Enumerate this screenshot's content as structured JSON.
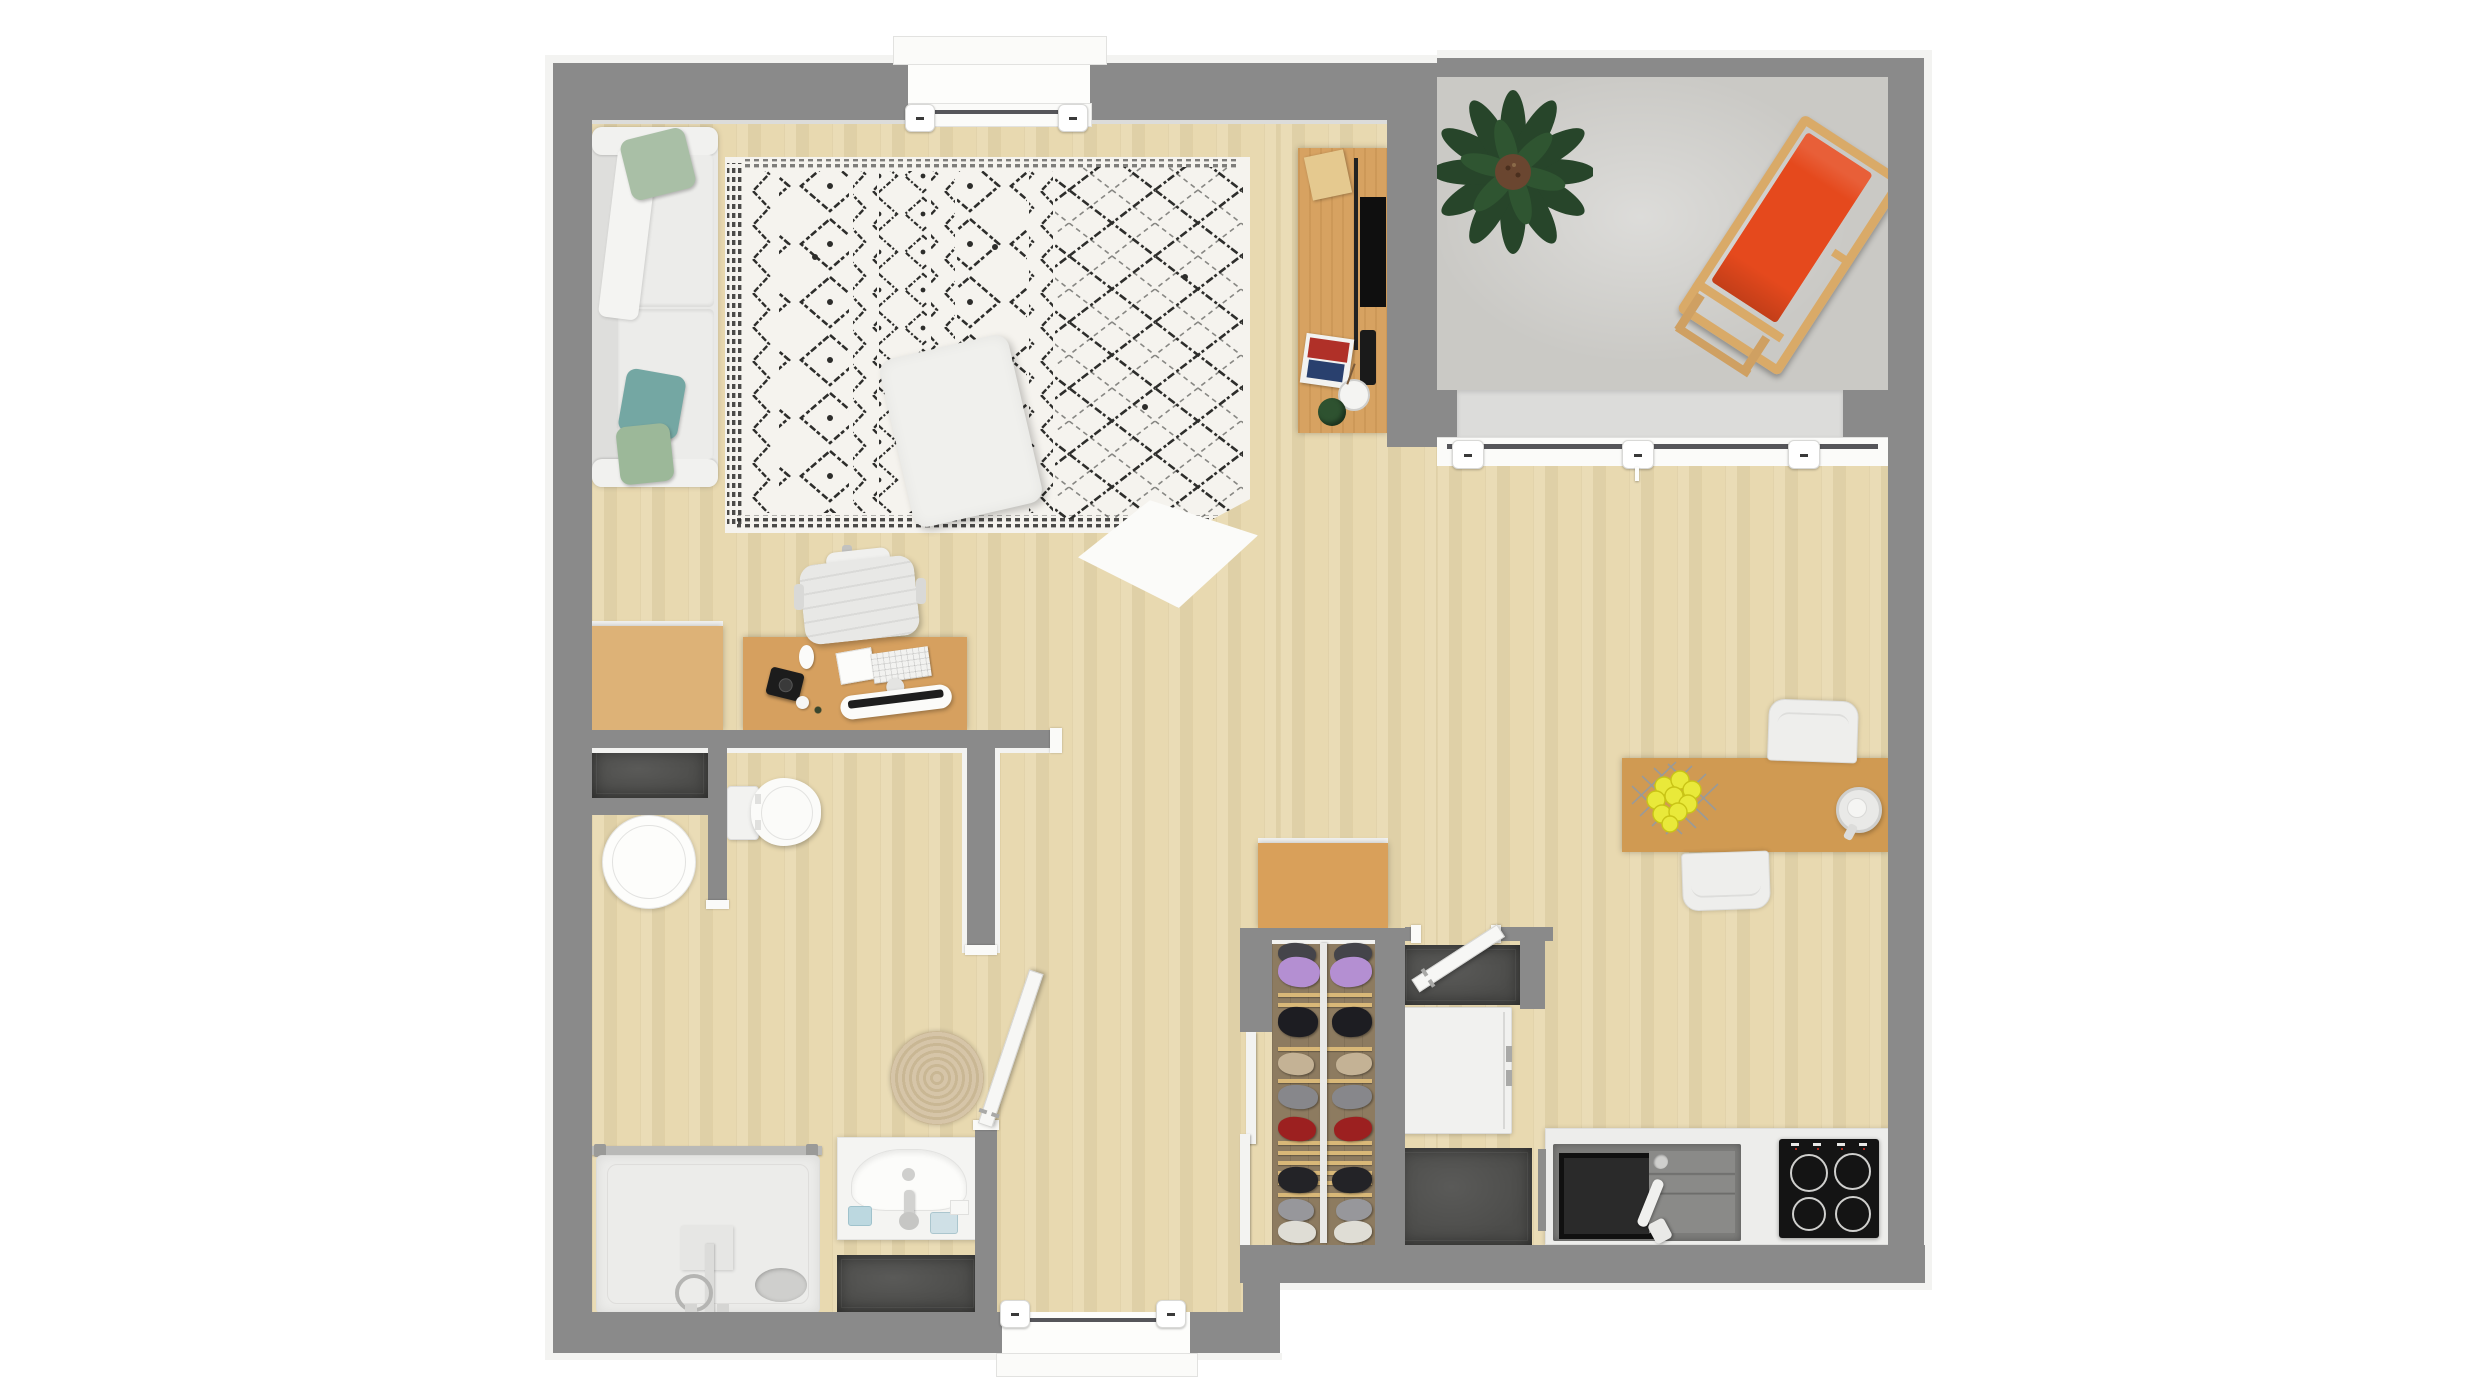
{
  "scene": {
    "title": "studio-apartment-floor-plan-top-view",
    "background": "#ffffff",
    "view": "top-down 3D render",
    "visible_text": "none"
  },
  "palette": {
    "wall": "#8a8a8a",
    "trim": "#f3f3f1",
    "wood": "#e8d8ae",
    "furnwood": "#d7a261",
    "furnwood2": "#ddb277",
    "framewood": "#d9aa68",
    "concrete": "#cac9c5",
    "tile": "#4c4c4a",
    "closetfloor": "#8d7b60",
    "accent": "#e5491d",
    "green": "#27452a",
    "slat": "#d9b878",
    "jute": "#d6c5a8",
    "rugbg": "#f5f3ee",
    "rugink": "#2d2d2b",
    "pillow_sage": "#a9bfa6",
    "pillow_teal": "#74a7a3",
    "lemon": "#e9e93a"
  },
  "rooms": [
    {
      "id": "living-room",
      "label": "Living room"
    },
    {
      "id": "balcony",
      "label": "Balcony"
    },
    {
      "id": "bathroom",
      "label": "Bathroom"
    },
    {
      "id": "hallway",
      "label": "Hallway"
    },
    {
      "id": "closet",
      "label": "Closet"
    },
    {
      "id": "entry",
      "label": "Entry"
    },
    {
      "id": "kitchen",
      "label": "Kitchen"
    },
    {
      "id": "dining-area",
      "label": "Dining area"
    }
  ],
  "doors": [
    {
      "id": "bathroom-door",
      "state": "open"
    },
    {
      "id": "entry-door",
      "state": "open"
    }
  ],
  "windows": [
    {
      "id": "living-room-window"
    },
    {
      "id": "balcony-window",
      "handles": 3
    },
    {
      "id": "hall-window",
      "handles": 2
    }
  ],
  "furniture": [
    {
      "id": "sofa",
      "label": "White sofa with pillows",
      "room": "living-room"
    },
    {
      "id": "berber-rug",
      "label": "Black and white Berber rug with folded corner",
      "room": "living-room"
    },
    {
      "id": "ottoman",
      "label": "White ottoman",
      "room": "living-room"
    },
    {
      "id": "tv-console",
      "label": "TV console with TV, magazines, vase and plant",
      "room": "living-room"
    },
    {
      "id": "desk",
      "label": "Desk with monitor, keyboard, mouse and camera",
      "room": "living-room"
    },
    {
      "id": "desk-chair",
      "label": "White office chair",
      "room": "living-room"
    },
    {
      "id": "low-cabinet",
      "label": "Low wooden cabinet",
      "room": "living-room"
    },
    {
      "id": "potted-plant",
      "label": "Large potted plant",
      "room": "balcony"
    },
    {
      "id": "deck-chair",
      "label": "Orange wooden deck chair",
      "room": "balcony"
    },
    {
      "id": "toilet",
      "label": "Toilet",
      "room": "bathroom"
    },
    {
      "id": "laundry-basket",
      "label": "Round laundry basket",
      "room": "bathroom"
    },
    {
      "id": "shower",
      "label": "Walk-in shower",
      "room": "bathroom"
    },
    {
      "id": "vanity-sink",
      "label": "Vanity sink",
      "room": "bathroom"
    },
    {
      "id": "jute-rug",
      "label": "Round jute rug",
      "room": "bathroom"
    },
    {
      "id": "dark-mat-bath",
      "label": "Dark tile mat",
      "room": "bathroom"
    },
    {
      "id": "dresser",
      "label": "Wooden dresser",
      "room": "closet"
    },
    {
      "id": "shoe-rack",
      "label": "Shoe rack with shoes",
      "room": "closet"
    },
    {
      "id": "washing-machine",
      "label": "White appliance",
      "room": "entry"
    },
    {
      "id": "entry-mats",
      "label": "Dark tile mats",
      "room": "entry"
    },
    {
      "id": "kitchen-counter",
      "label": "Kitchen counter",
      "room": "kitchen"
    },
    {
      "id": "kitchen-sink",
      "label": "Grey sink unit with faucet",
      "room": "kitchen"
    },
    {
      "id": "cooktop",
      "label": "Four-burner cooktop",
      "room": "kitchen"
    },
    {
      "id": "dining-table",
      "label": "Wooden dining table",
      "room": "dining-area"
    },
    {
      "id": "dining-chairs",
      "label": "Two white chairs",
      "room": "dining-area"
    },
    {
      "id": "fruit-basket",
      "label": "Wire basket with lemons",
      "room": "dining-area"
    },
    {
      "id": "glass-cup",
      "label": "Glass cup",
      "room": "dining-area"
    }
  ],
  "closet": {
    "slats": [
      52,
      62,
      106,
      138,
      200,
      210,
      220,
      230,
      240,
      252
    ],
    "shoe_rows": [
      {
        "y": 2,
        "h": 22,
        "w": 38,
        "color": "#44444a",
        "tilt": 4
      },
      {
        "y": 16,
        "h": 30,
        "w": 42,
        "color": "#b48fd2",
        "tilt": 6
      },
      {
        "y": 66,
        "h": 30,
        "w": 40,
        "color": "#1d1d22",
        "tilt": 3
      },
      {
        "y": 112,
        "h": 22,
        "w": 36,
        "color": "#c4b295",
        "tilt": 5
      },
      {
        "y": 144,
        "h": 24,
        "w": 40,
        "color": "#87878b",
        "tilt": 4
      },
      {
        "y": 176,
        "h": 24,
        "w": 38,
        "color": "#9c2020",
        "tilt": 6
      },
      {
        "y": 226,
        "h": 26,
        "w": 40,
        "color": "#232327",
        "tilt": 3
      },
      {
        "y": 258,
        "h": 22,
        "w": 36,
        "color": "#97979b",
        "tilt": 5
      },
      {
        "y": 280,
        "h": 22,
        "w": 38,
        "color": "#dfddd5",
        "tilt": 4
      }
    ]
  }
}
